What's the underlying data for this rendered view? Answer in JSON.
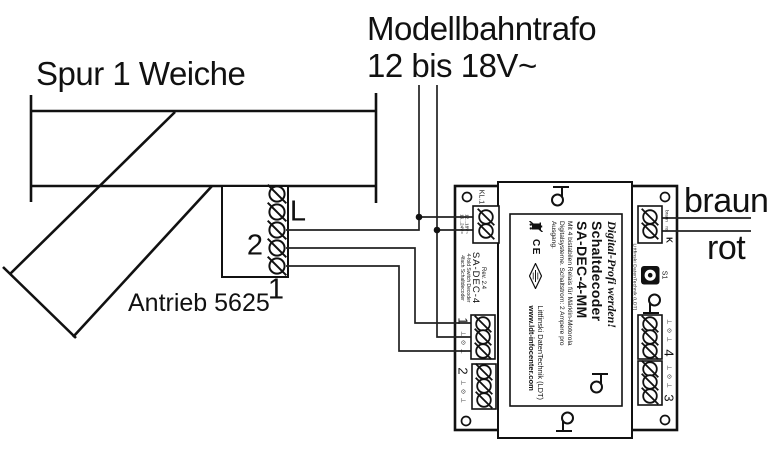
{
  "track": {
    "label": "Spur 1 Weiche",
    "drive_label": "Antrieb 5625",
    "terminals": {
      "l": "L",
      "two": "2",
      "one": "1"
    }
  },
  "transformer": {
    "name": "Modellbahntrafo",
    "voltage": "12 bis 18V~"
  },
  "wires": {
    "brown": "braun",
    "red": "rot"
  },
  "decoder": {
    "power_terminal": "KL.1",
    "power_voltage_line1": "12...18V~",
    "power_voltage_line2": "16...24V=",
    "board_rev": "Rev. 2.4",
    "board_name": "SA-DEC-4",
    "board_type_en": "4-fold Switch Decoder",
    "board_type_de": "4fach Schaltdecoder",
    "side_company": "Littfinski DatenTechnik (LDT)",
    "track_terminal": "K",
    "track_brown": "braun",
    "track_red": "rot",
    "prog_button": "S1",
    "terminal_marks": "⊥ ⊙ ⊥",
    "outputs": {
      "o1": "1",
      "o2": "2",
      "o3": "3",
      "o4": "4"
    },
    "label": {
      "slogan": "Digital-Profi werden!",
      "product_line1": "Schaltdecoder",
      "product_line2": "SA-DEC-4-MM",
      "desc_line1": "Mit 4 bistabilen Relais für Märklin-Motorola",
      "desc_line2": "Digitalsysteme. Schaltstrom: 2 Ampere pro",
      "desc_line3": "Ausgang.",
      "ce": "CE",
      "company": "Littfinski DatenTechnik (LDT)",
      "website": "www.ldt-infocenter.com"
    }
  }
}
